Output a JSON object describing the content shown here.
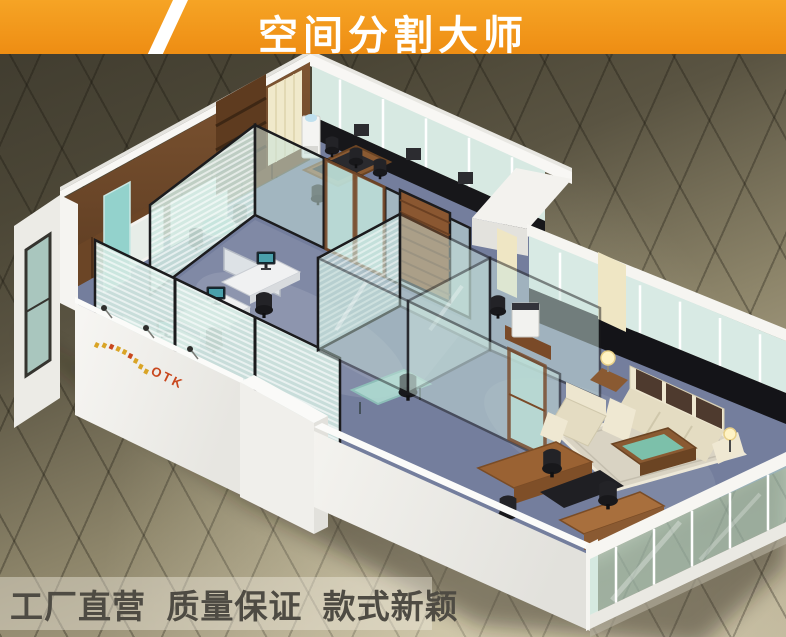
{
  "banner": {
    "title": "空间分割大师",
    "bg_color": "#F2941E",
    "text_color": "#FFFFFF"
  },
  "footer": {
    "tagline": "工厂直营  质量保证  款式新颖",
    "text_color": "#4E4B43"
  },
  "scene": {
    "logo_text": "OTK",
    "description": "Isometric cutaway 3D render of an office showroom divided by black-framed glass partitions: open-plan workstations, glass manager cabin, conference corner, and an executive lounge with cream sofa set and wooden desk, standing on a tiled exhibition floor",
    "colors": {
      "carpet_blue": "#747E9D",
      "glass_green": "#CFE7E0",
      "frame_black": "#1C1C1E",
      "wood_brown": "#7A4A28",
      "wall_white": "#F2F1ED",
      "tile_dark": "#46412F",
      "tile_light": "#BCB397",
      "sofa_cream": "#E8E1C8",
      "logo_red": "#C8471D",
      "logo_gold": "#D9A426"
    }
  }
}
